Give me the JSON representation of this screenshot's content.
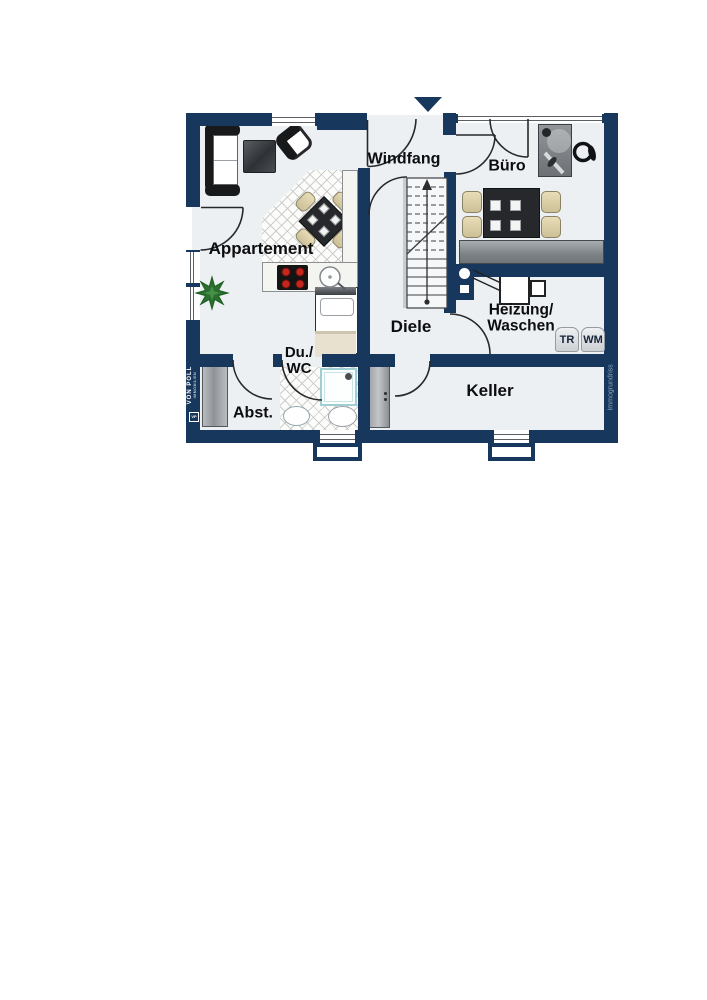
{
  "rooms": {
    "appartement": "Appartement",
    "windfang": "Windfang",
    "buero": "Büro",
    "diele": "Diele",
    "heizung_line1": "Heizung/",
    "heizung_line2": "Waschen",
    "keller": "Keller",
    "abstellraum": "Abst.",
    "du_line1": "Du./",
    "du_line2": "WC"
  },
  "appliances": {
    "dryer_label": "TR",
    "washer_label": "WM"
  },
  "branding": {
    "left_name": "VON POLL",
    "left_sub": "IMMOBILIEN",
    "left_logo": "VP",
    "right_credit": "Immogrundriss"
  },
  "colors": {
    "wall": "#17375c",
    "floor": "#edf0f3"
  }
}
